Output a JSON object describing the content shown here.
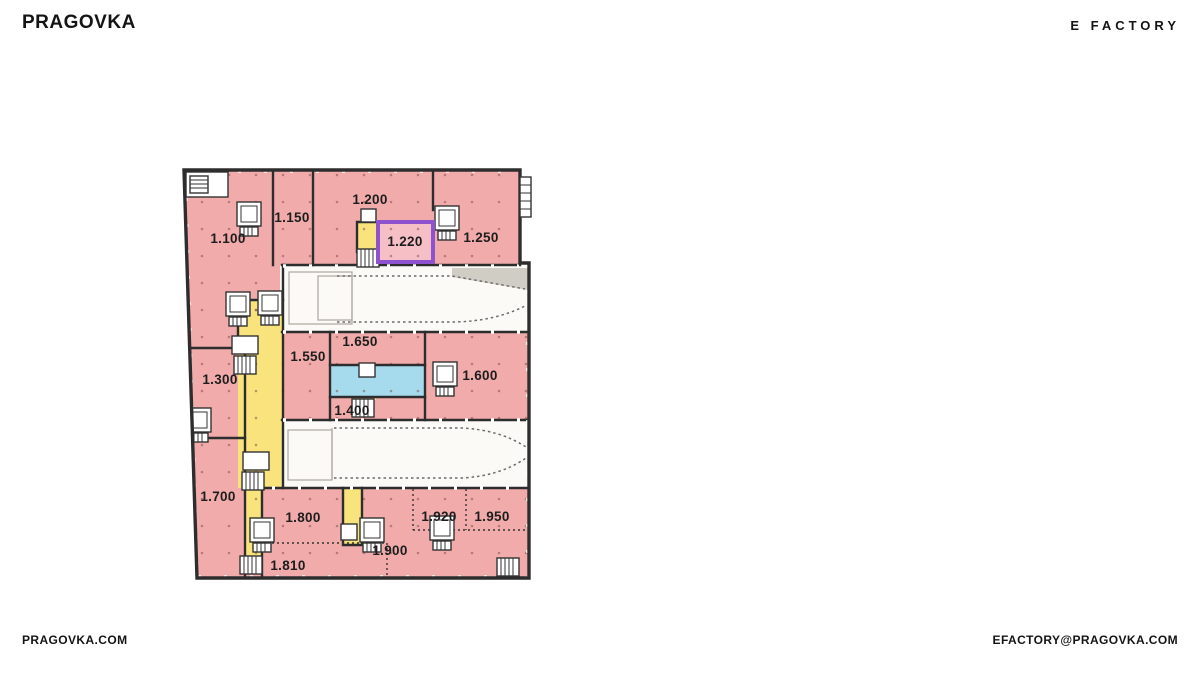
{
  "header": {
    "logo": "PRAGOVKA",
    "brand": "E FACTORY"
  },
  "footer": {
    "website": "PRAGOVKA.COM",
    "email": "EFACTORY@PRAGOVKA.COM"
  },
  "floorplan": {
    "floor": "1",
    "highlighted_unit": "1.220",
    "colors": {
      "room_pink": "#f2abab",
      "highlight_fill": "#f6bfc6",
      "highlight_border": "#8e52cf",
      "corridor_yellow": "#f8e37d",
      "utility_blue": "#a6dbee",
      "hall_white": "#fbfaf6",
      "wall": "#2d2d2d"
    },
    "units": [
      {
        "id": "1.100"
      },
      {
        "id": "1.150"
      },
      {
        "id": "1.200"
      },
      {
        "id": "1.220"
      },
      {
        "id": "1.250"
      },
      {
        "id": "1.300"
      },
      {
        "id": "1.400"
      },
      {
        "id": "1.550"
      },
      {
        "id": "1.600"
      },
      {
        "id": "1.650"
      },
      {
        "id": "1.700"
      },
      {
        "id": "1.800"
      },
      {
        "id": "1.810"
      },
      {
        "id": "1.900"
      },
      {
        "id": "1.920"
      },
      {
        "id": "1.950"
      }
    ]
  }
}
